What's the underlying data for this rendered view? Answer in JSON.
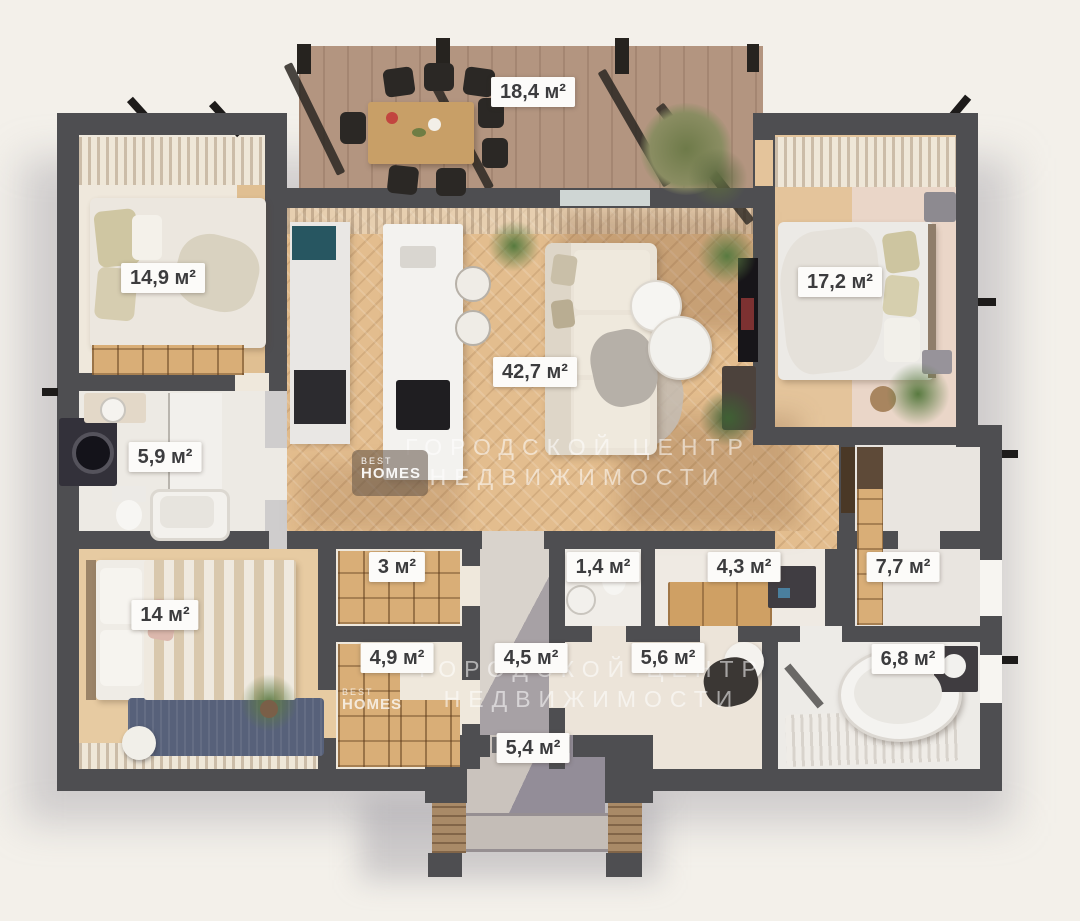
{
  "floor_plan": {
    "unit": "м²",
    "rooms": [
      {
        "id": "terrace",
        "area_label": "18,4 м²"
      },
      {
        "id": "bedroom-top-left",
        "area_label": "14,9 м²"
      },
      {
        "id": "bedroom-top-right",
        "area_label": "17,2 м²"
      },
      {
        "id": "living-kitchen",
        "area_label": "42,7 м²"
      },
      {
        "id": "bathroom-left",
        "area_label": "5,9 м²"
      },
      {
        "id": "bedroom-bottom-left",
        "area_label": "14 м²"
      },
      {
        "id": "closet",
        "area_label": "3 м²"
      },
      {
        "id": "wc",
        "area_label": "1,4 м²"
      },
      {
        "id": "utility-room",
        "area_label": "4,3 м²"
      },
      {
        "id": "pantry-right",
        "area_label": "7,7 м²"
      },
      {
        "id": "wardrobe",
        "area_label": "4,9 м²"
      },
      {
        "id": "entrance-hall",
        "area_label": "4,5 м²"
      },
      {
        "id": "hallway",
        "area_label": "5,6 м²"
      },
      {
        "id": "bathroom-right",
        "area_label": "6,8 м²"
      },
      {
        "id": "porch",
        "area_label": "5,4 м²"
      }
    ],
    "watermarks": {
      "brand_small": "BEST",
      "brand_large": "HOMES",
      "agency_line1": "ГОРОДСКОЙ ЦЕНТР",
      "agency_line2": "НЕДВИЖИМОСТИ"
    },
    "colors": {
      "background": "#f3f0ea",
      "wall": "#4e4e51",
      "wood_floor": "#e3bd8e",
      "terrace_deck": "#b39580",
      "label_background": "#fcfbf9",
      "label_text": "#3c3c3e"
    }
  }
}
